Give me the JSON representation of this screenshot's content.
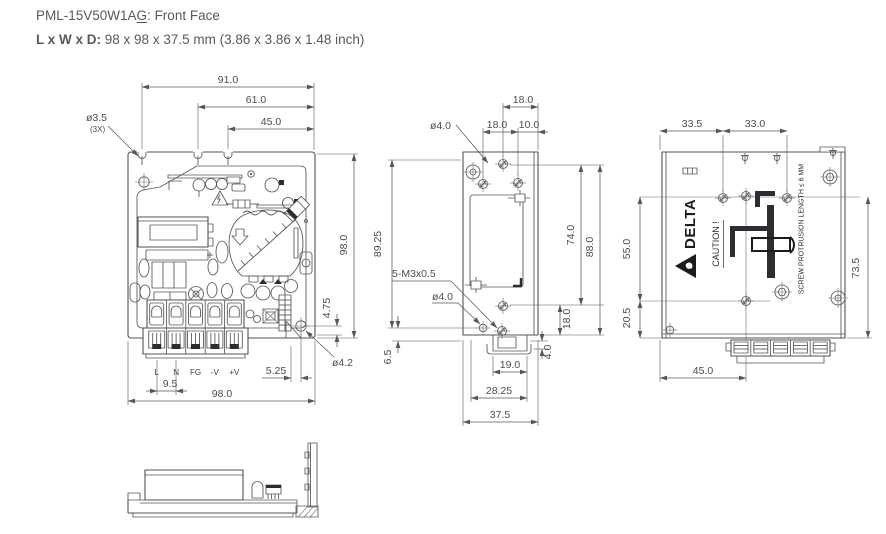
{
  "header": {
    "model_prefix": "PML-15V50W1A",
    "model_underlined": "G",
    "title_suffix": ": Front Face",
    "size_label": "L x W x D:",
    "size_value": "98 x 98 x 37.5 mm (3.86 x 3.86 x 1.48 inch)"
  },
  "colors": {
    "line": "#515257",
    "text": "#4b4c4f"
  },
  "front_view": {
    "w91": "91.0",
    "w61": "61.0",
    "w45": "45.0",
    "hole_dia": "ø3.5",
    "hole_qty": "(3X)",
    "h98": "98.0",
    "w98b": "98.0",
    "p95": "9.5",
    "off525": "5.25",
    "off475": "4.75",
    "hole42": "ø4.2",
    "terminals": [
      "L",
      "N",
      "FG",
      "-V",
      "+V"
    ]
  },
  "side_view": {
    "t18_top": "18.0",
    "t18_mid": "18.0",
    "t10": "10.0",
    "hole40_top": "ø4.0",
    "hole40_bot": "ø4.0",
    "h8925": "89.25",
    "h74": "74.0",
    "h88": "88.0",
    "h18_bot": "18.0",
    "thread": "5-M3x0.5",
    "h65": "6.5",
    "d4": "4.0",
    "w19": "19.0",
    "w2825": "28.25",
    "w375": "37.5"
  },
  "rear_view": {
    "w335": "33.5",
    "w330": "33.0",
    "h55": "55.0",
    "h205": "20.5",
    "h735": "73.5",
    "w45": "45.0",
    "brand": "DELTA",
    "caution": "CAUTION !",
    "note": "SCREW PROTRUSION LENGTH ≤ 6 MM"
  }
}
